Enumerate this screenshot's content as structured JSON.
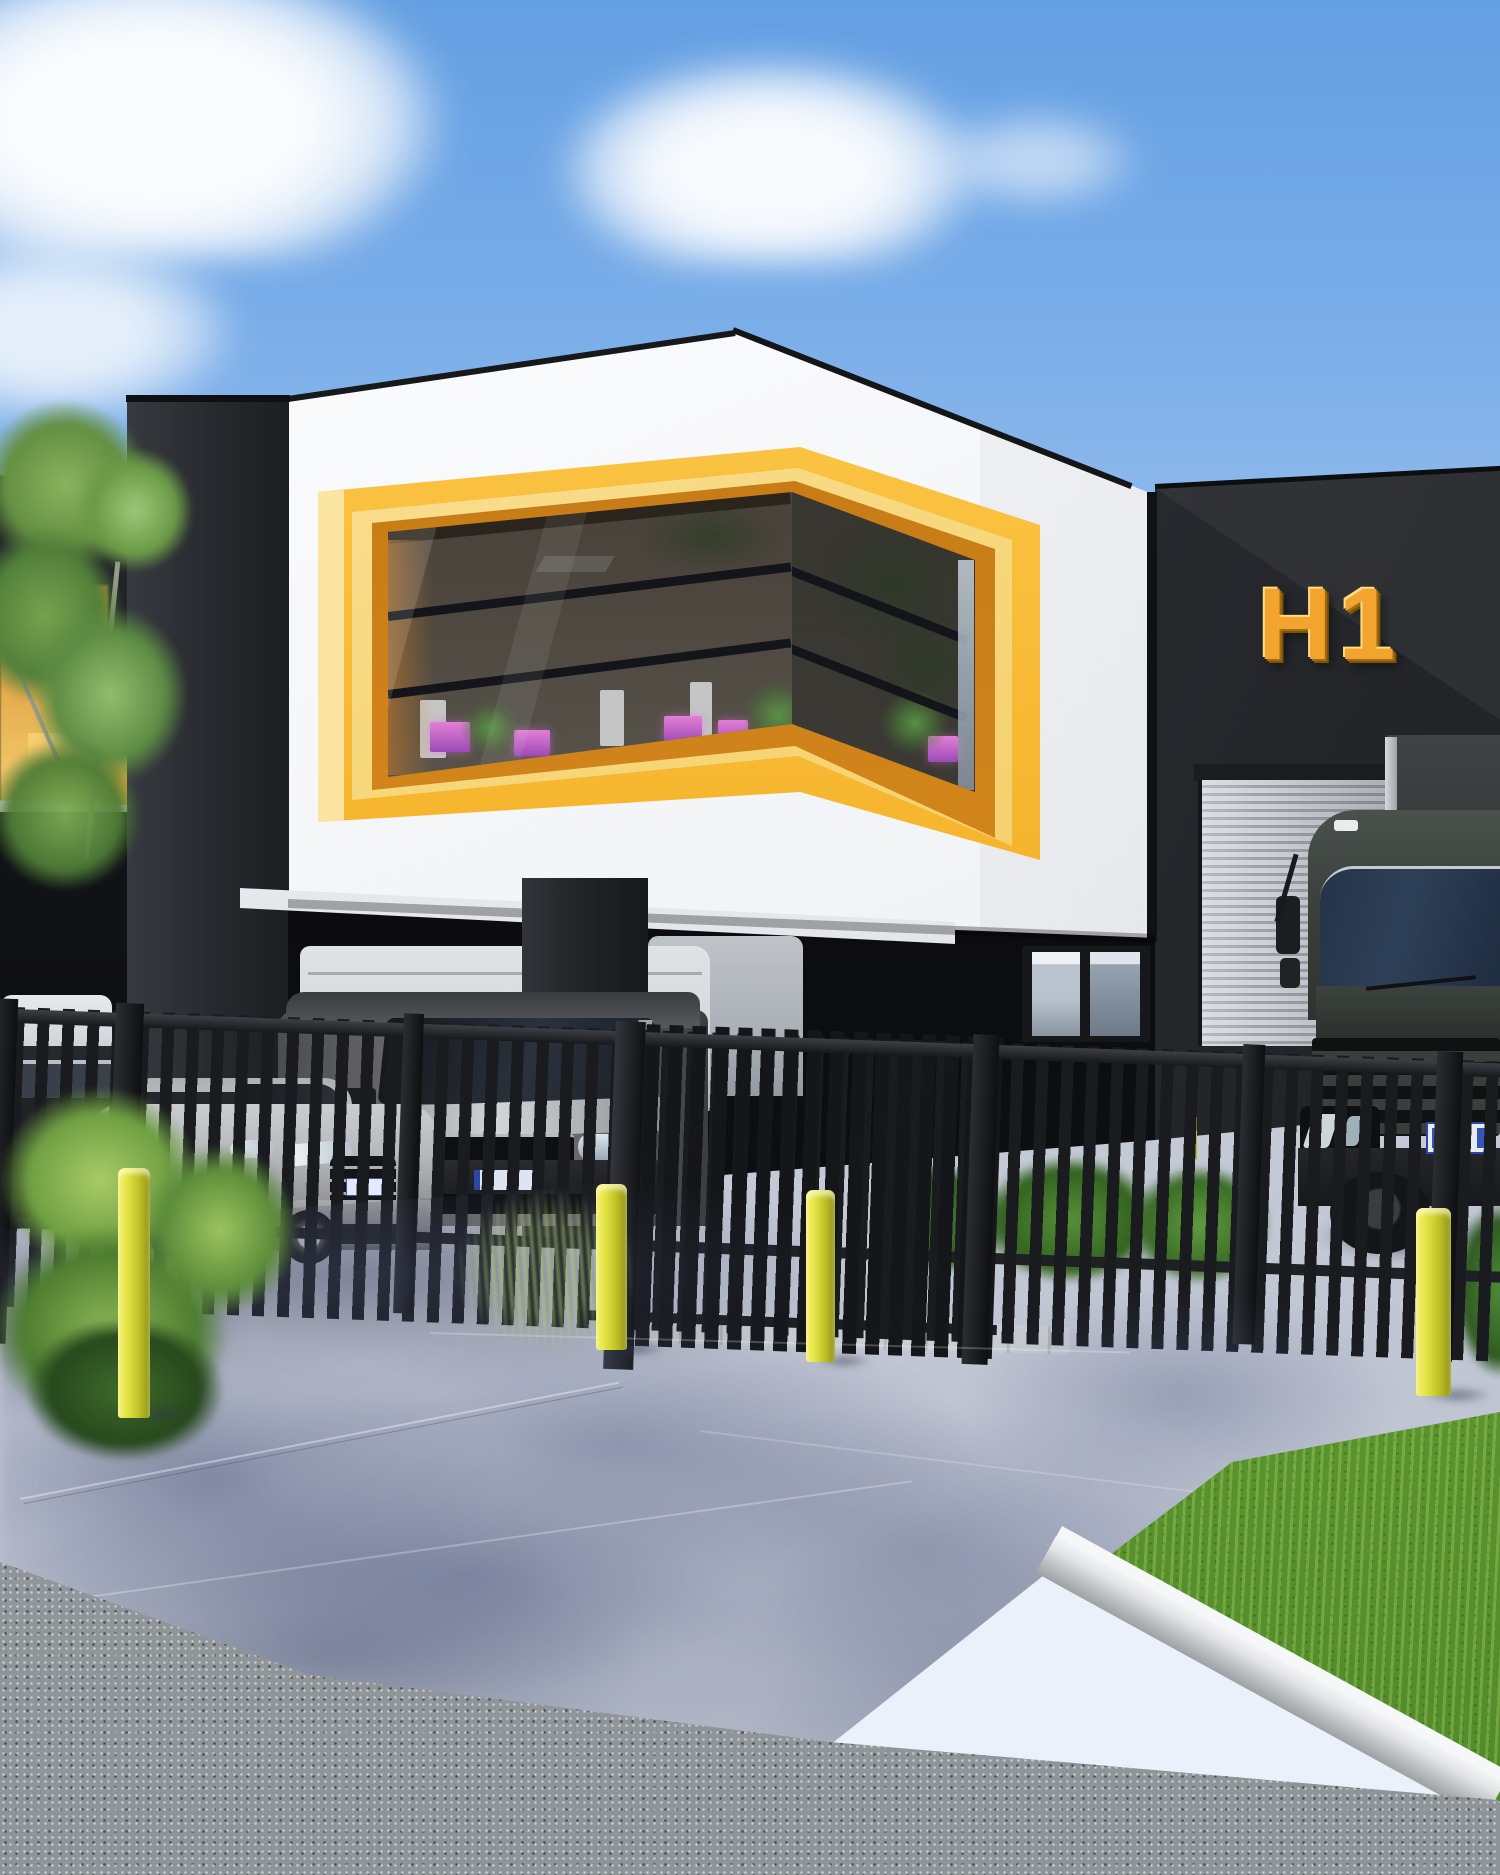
{
  "scene": {
    "description": "Photorealistic daytime exterior rendering of a modern industrial office unit: white cantilevered upper storey with a wrap-around corner window in a bold yellow frame, dark charcoal warehouse wings, black palisade fence with gate, yellow safety bollards, parked vehicles and landscaped concrete driveway",
    "setting": "industrial estate street frontage",
    "lighting": "bright sunshine, blue sky with scattered white clouds, dappled tree shadows on the driveway"
  },
  "signage": {
    "unit_label": "H1",
    "style": "3D gold channel letters",
    "mounted_on": "dark charcoal facade"
  },
  "palette": {
    "sky_top": "#649FE2",
    "sky_horizon": "#EAF1FB",
    "cloud_white": "#FFFFFF",
    "facade_white": "#F2F4F6",
    "facade_charcoal": "#2A2D32",
    "undercroft_black": "#0B0C0E",
    "window_frame_yellow": "#F6B52E",
    "window_frame_orange": "#D0831A",
    "frame_highlight_cream": "#FBE9B4",
    "glass_tint": "#4A443C",
    "monitor_glow_pink": "#C95FC9",
    "sign_gold": "#F2A42F",
    "roller_door_silver": "#B9BDC5",
    "fence_black": "#1A1C1F",
    "bollard_yellow": "#E3E345",
    "driveway_concrete": "#C6CBD7",
    "shadow_blue": "#58617F",
    "asphalt_grey": "#9AA0A3",
    "grass_green": "#69A538",
    "foliage_green": "#6A9A46",
    "truck_grey_green": "#3A3F3C",
    "van_grey": "#66676A",
    "car_silver": "#B3B5B8",
    "white_van": "#E6EAEE",
    "licence_plate_blue": "#3456B8"
  },
  "objects": {
    "buildings": [
      "white cantilevered office box",
      "yellow wrap-around corner window frame",
      "charcoal left pillar",
      "charcoal right warehouse wing with H1 letters",
      "silver roller shutter door",
      "glass entry door",
      "neighbouring unit with amber signage"
    ],
    "vehicles": [
      "grey transporter van",
      "silver hatchback",
      "white box van in undercroft",
      "second white van",
      "dark car at far left",
      "dark grey truck with box body"
    ],
    "street_furniture": [
      "black palisade fence and gate",
      "four yellow safety bollards",
      "concrete kerb",
      "grass verge",
      "eucalyptus tree",
      "ferns and ornamental grasses",
      "low hedges behind fence"
    ]
  }
}
